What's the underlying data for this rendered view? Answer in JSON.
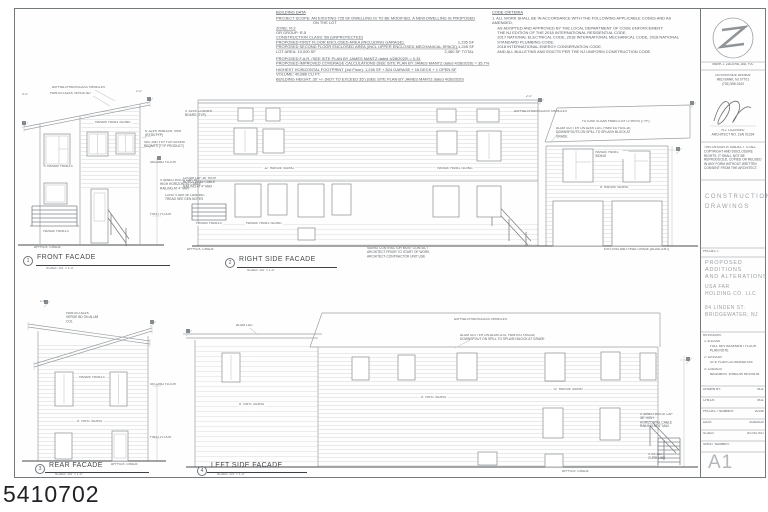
{
  "watermark": "5410702",
  "building_data": {
    "title": "BUILDING DATA",
    "rows": [
      {
        "t": "PROJECT SCOPE:   AN EXISTING 725 SF DWELLING IS TO BE MODIFIED.  A NEW DWELLING IS PROPOSED"
      },
      {
        "t": "ON THE LOT"
      },
      {
        "t": "ZONE: R-2"
      },
      {
        "t": "OR GROUP:  R-5"
      },
      {
        "t": "CONSTRUCTION CLASS:  5B (UNPROTECTED)"
      },
      {
        "t": "PROPOSED FIRST FLOOR ENCLOSED AREA (INCLUDING GARAGE):",
        "v": "1,235 SF"
      },
      {
        "t": "PROPOSED SECOND FLOOR ENCLOSED AREA (INCL UPPER ENCLOSED MECHANICAL SPACE):",
        "v": "1,245 SF"
      },
      {
        "t": "LOT AREA: 10,000 SF",
        "v": "2,480 SF TOTAL"
      },
      {
        "t": "PROPOSED F.A.R. (SEE SITE PLAN BY JAMES MANTZ dated 4/28/2020)  =  0.31"
      },
      {
        "t": "PROPOSED IMPROVED COVERAGE CALCULATIONS (SEE SITE PLAN BY JAMES MANTZ dated 4/28/2020)  =  35.7%"
      },
      {
        "t": "HIGHEST HORIZONTAL FOOTPRINT (1st Floor):  1,245 SF + 824 GARAGE + 16 DECK + 1 OPEN SF"
      },
      {
        "t": "VOLUME:          40,886 CU FT."
      },
      {
        "t": "BUILDING HEIGHT:    30' +/-  (NOT TO EXCEED 35')  (SEE SITE PLAN BY JAMES MANTZ dated 4/28/2020)"
      }
    ]
  },
  "code_criteria": {
    "title": "CODE CRITERIA",
    "lines": [
      "1.  ALL WORK SHALL BE IN ACCORDANCE WITH THE FOLLOWING APPLICABLE CODES AND AS AMENDED,",
      "AS ADOPTED AND APPROVED BY THE LOCAL DEPARTMENT OF CODE ENFORCEMENT:",
      "THE NJ EDITION OF THE 2018 INTERNATIONAL RESIDENTIAL CODE,",
      "2017 NATIONAL ELECTRICAL CODE, 2018 INTERNATIONAL MECHANICAL CODE, 2018 NATIONAL STANDARD PLUMBING CODE,",
      "2018 INTERNATIONAL ENERGY CONSERVATION CODE,",
      "AND ALL BULLETINS AND EDICTS PER THE NJ UNIFORM CONSTRUCTION CODE."
    ]
  },
  "titles": {
    "front": {
      "num": "1",
      "name": "FRONT FACADE",
      "scale": "SCALE: 1/4\" = 1'-0\""
    },
    "right": {
      "num": "2",
      "name": "RIGHT SIDE FACADE",
      "scale": "SCALE: 1/4\" = 1'-0\""
    },
    "rear": {
      "num": "3",
      "name": "REAR FACADE",
      "scale": "SCALE: 1/4\" = 1'-0\""
    },
    "left": {
      "num": "4",
      "name": "LEFT SIDE FACADE",
      "scale": "SCALE: 1/4\" = 1'-0\""
    }
  },
  "ann": {
    "front_shingles": "ASPHALT/FIBERGLASS SHINGLES",
    "front_verge": "PAINTED AZEK VERGE BD",
    "front_panel_siding": "HARDIE PANEL SIDING",
    "front_panels_mid": "HARDIE PANELS",
    "front_panels_low": "HARDIE PANELS",
    "front_trim": "8\" AZEK WINDOW TRIM (EXTR TYP)",
    "front_assem": "SEE 2ND FLR FOR ASSEM REQMTS (TYP PRODUCT)",
    "front_second_floor": "SECOND FLOOR",
    "front_cable": "STAINED WOOD CAP 36\" HIGH HORIZONTAL CABLE RAILING AT 4\" MAX",
    "front_stair": "LONG STAIR W/ LANDING TREAD SEE GEN NOTES",
    "front_first_floor": "FIRST FLOOR",
    "front_grade": "APPROX. GRADE",
    "front_dim_l": "4'-0\"",
    "front_dim_r": "2'-0\"",
    "right_corner": "4\" AZEK CORNER BOARD (TYP)",
    "right_cable": "CEDAR LAP 36\" HIGH HORIZONTAL CABLE RAILING AT 4\" MAX",
    "right_siding12": "12\" HARDIE SIDING",
    "right_panel_siding_up": "HARDIE PANEL SIDING",
    "right_panels": "HARDIE PANELS",
    "right_panel_siding_low": "HARDIE PANEL SIDING",
    "right_grade": "APPROX. GRADE",
    "right_contractor": "SIDING CONTRACTOR MUST CONTACT ARCHITECT PRIOR TO START OF WORK.  ARCHITECT-CONTRACTOR UNIT USE",
    "gar_shingles": "ASPHALT/FIBERGLASS SHINGLES",
    "gar_solar": "FUTURE SOLAR PANELS BY OTHERS (TYP)",
    "gar_gutter": "ALUM GUTTER ON AZEK LDG, PAINTED FASCIA; DOWNSPOUTS ON SPILL TO SPLASH BLOCK AT GRADE",
    "gar_panel_siding": "HARDIE PANEL SIDING",
    "gar_siding8": "8\" HARDIE SIDING",
    "gar_grade": "EXISTING AND FINAL GRADE (ADJACENT)",
    "gar_dim": "2'-0\"",
    "rear_verge": "PAINTED AZEK VERGE BD ON ALUM COL",
    "rear_panels": "HARDIE PANELS",
    "rear_vinyl": "8\" VINYL SIDING",
    "rear_second_floor": "SECOND FLOOR",
    "rear_first_floor": "FIRST FLOOR",
    "rear_grade": "APPROX. GRADE",
    "rear_dim": "1'-6\"",
    "left_alum": "ALUM LDG",
    "left_shingles": "ASPHALT/FIBERGLASS SHINGLES",
    "left_gutter": "ALUM GUTTER ON ALUM LDG, PAINTED FASCIA; DOWNSPOUT ON SPILL TO SPLASH BLOCK AT GRADE",
    "left_vinyl": "8\" VINYL SIDING",
    "left_vinyl2": "8\" VINYL SIDING",
    "left_hardie12": "12\" HARDIE SIDING",
    "left_cable": "STAINED WOOD CAP 36\" HIGH HORIZONTAL CABLE RAILING AT 4\" MAX",
    "left_stucco": "STUCCO CURB LINE",
    "left_grade": "APPROX. GRADE"
  },
  "titleblock": {
    "firm_name": "MARK J. ZACERA, AIA, P.A.",
    "address": [
      "25 RIVERSIDE AVENUE",
      "RED BANK, NJ 07701",
      "(732) 555-0100"
    ],
    "license": [
      "N.J. LICENSED",
      "ARCHITECT NO. 21AI 01234"
    ],
    "disclaimer": "THIS DESIGN IS SUBJECT TO ALL COPYRIGHT AND DISCLOSURE RIGHTS.  IT SHALL NOT BE REPRODUCED, COPIED OR REUSED IN ANY FORM WITHOUT WRITTEN CONSENT FROM THE ARCHITECT.",
    "doc_type": "CONSTRUCTION DRAWINGS",
    "project_label": "PROJECT:",
    "project_name": [
      "PROPOSED",
      "ADDITIONS",
      "AND ALTERATIONS"
    ],
    "client": [
      "USA FAR",
      "HOLDING CO. LLC"
    ],
    "location": [
      "84 LINDEN ST.",
      "BRIDGEWATER, NJ"
    ],
    "revisions_label": "REVISIONS:",
    "revisions": [
      {
        "id": "1:",
        "date": "4/1/2020",
        "desc": "FULL REV BASEMENT FLOOR PLAN NOTE"
      },
      {
        "id": "2:",
        "date": "10/3/2020",
        "desc": "SITE PLAN COORDINATION"
      },
      {
        "id": "3:",
        "date": "11/5/2020",
        "desc": "BASEMENT WINDOW REVISION"
      }
    ],
    "fields": [
      {
        "label": "DRAWN BY:",
        "value": "MJZ"
      },
      {
        "label": "CHECK:",
        "value": "MJZ"
      },
      {
        "label": "PROJECT NUMBER:",
        "value": "20106"
      },
      {
        "label": "DATE:",
        "value": "4/28/2020"
      },
      {
        "label": "SCALE:",
        "value": "AS NOTED"
      },
      {
        "label": "SHEET NUMBER:",
        "value": ""
      }
    ],
    "sheet_number": "A1"
  }
}
